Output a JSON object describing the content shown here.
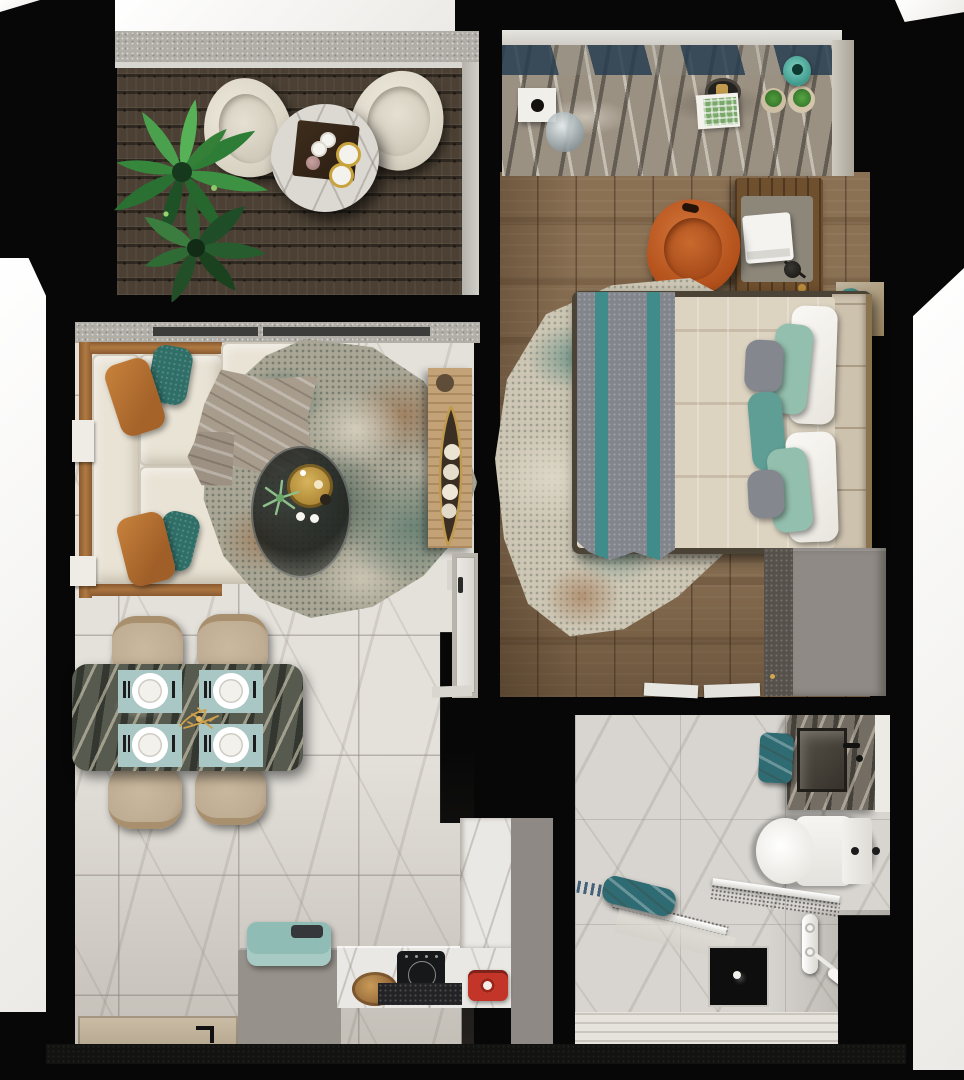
{
  "scene": {
    "description": "Top-down 3D rendered floor plan of a one-bedroom apartment with balcony, living-dining-kitchen area, bedroom and bathroom",
    "view": "top-down interior visualization",
    "background": "#070707"
  },
  "palette": {
    "exterior_white": "#f5f4f2",
    "wall_black": "#0a0a09",
    "wall_band": "#a9a6a0",
    "deck_wood": "#4b4033",
    "tile_floor": "#e4e1db",
    "bedroom_wood": "#8b7154",
    "cream_fabric": "#e9e3d5",
    "orange_accent": "#bb7233",
    "teal_accent": "#2f6f68",
    "teal_towel": "#2f6b72",
    "pillow_green": "#93bfae",
    "pillow_gray": "#85878f",
    "lumbar_teal": "#5f9e95",
    "duvet": "#dcd3c1",
    "throw_gray": "#83858d",
    "throw_stripe": "#3f8c8b",
    "placemat_blue": "#a9c7c5",
    "mint_breadbox": "#8fbcb4",
    "red_appliance": "#c23528",
    "gray_cabinet": "#8f8a85",
    "gold": "#c09a4e",
    "plant_green": "#2e7d36",
    "desk_chair_orange": "#bf5a22",
    "marble_table_dark": "#565a4f"
  },
  "rooms": {
    "balcony": {
      "label": "balcony",
      "items": [
        "potted-plant",
        "lounge-chair-left",
        "lounge-chair-right",
        "round-marble-table",
        "serving-tray",
        "coffee-cups",
        "gold-plates"
      ]
    },
    "living_room": {
      "label": "living room",
      "items": [
        "modular-sofa",
        "leather-pillows",
        "teal-pillows",
        "throw-blanket",
        "area-rug",
        "round-coffee-table",
        "gold-tray",
        "candles",
        "decor-plant",
        "wood-console",
        "leaf-bowl",
        "decor-spheres",
        "side-tables"
      ]
    },
    "dining_area": {
      "label": "dining area",
      "items": [
        "marble-dining-table",
        "placemats",
        "dinner-plates",
        "cutlery",
        "dining-chairs",
        "gold-centerpiece"
      ]
    },
    "kitchen": {
      "label": "kitchen",
      "items": [
        "gray-counter",
        "bread-box",
        "marble-counter",
        "bread-basket",
        "induction-cooktop",
        "hood-bar",
        "red-toaster",
        "tall-marble-cabinet"
      ]
    },
    "entry": {
      "label": "entry",
      "items": [
        "door-mat",
        "entry-door-handle"
      ]
    },
    "bedroom": {
      "label": "bedroom",
      "items": [
        "marble-dresser",
        "decor-box",
        "glass-sculpture",
        "round-tray",
        "magazine",
        "potted-succulents",
        "teal-vase",
        "desk",
        "laptop",
        "desk-lamp",
        "orange-desk-chair",
        "double-bed",
        "headboard",
        "duvet",
        "striped-foot-throw",
        "white-pillows",
        "green-pillows",
        "gray-pillows",
        "teal-lumbar-pillow",
        "area-rug",
        "nightstand",
        "wardrobe",
        "sparkle-curtain",
        "door-threshold",
        "interior-door"
      ]
    },
    "bathroom": {
      "label": "bathroom",
      "items": [
        "vanity-counter",
        "sink-basin",
        "black-faucet",
        "teal-hand-towel",
        "toilet",
        "glass-shower-screens",
        "teal-bath-towel",
        "floor-drain-mat",
        "shower-mixer",
        "hand-shower",
        "wet-floor-zone"
      ]
    }
  }
}
